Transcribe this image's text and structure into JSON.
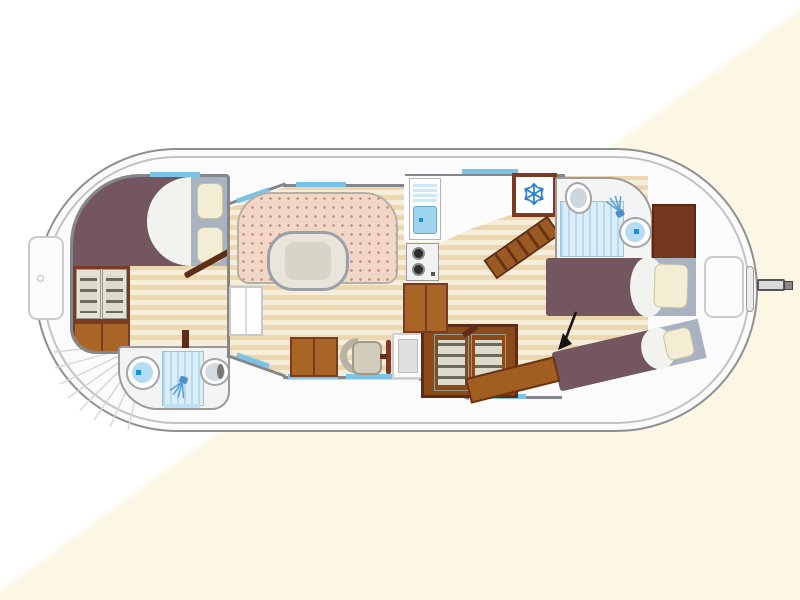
{
  "figure": "pleasure-boat-floor-plan-top-view",
  "palette": {
    "hull_line": "#8f8f8f",
    "deck": "#fbfbfb",
    "wall": "#84878c",
    "window": "#7cc3e8",
    "floor_light": "#f7eed9",
    "floor_dark": "#ecd7ae",
    "wood": "#a96526",
    "wood_dark": "#7b3a22",
    "door_wood": "#5e2d16",
    "bed": "#73565f",
    "pillow": "#f3edd3",
    "pillow_frame": "#a9b2c0",
    "sofa": "#f2d6c6",
    "sofa_dot": "#c69484",
    "table_fill": "#e9e5da",
    "table_border": "#9aa0a8",
    "water_light": "#cfe8f6",
    "water_mid": "#9fd4ee",
    "water_accent": "#1a8fd0",
    "snowflake_blue": "#2a7fd4",
    "shelf": "#6a6a58",
    "arrow": "#151515"
  },
  "rooms": [
    {
      "id": "bow-cabin",
      "contents": [
        "double-bed",
        "wardrobe",
        "cabinet",
        "door"
      ]
    },
    {
      "id": "bow-bathroom",
      "contents": [
        "toilet",
        "shower",
        "washbasin"
      ]
    },
    {
      "id": "saloon",
      "contents": [
        "u-shaped-dinette",
        "oval-table",
        "white-cabinet"
      ]
    },
    {
      "id": "helm-station",
      "contents": [
        "chart-desk",
        "helm-seat",
        "steering-wheel",
        "console",
        "wardrobe"
      ]
    },
    {
      "id": "galley",
      "contents": [
        "sink-with-drainer",
        "two-burner-stove",
        "cabinet",
        "refrigerator",
        "companionway-stairs"
      ]
    },
    {
      "id": "aft-bathroom",
      "contents": [
        "washbasin",
        "shower",
        "toilet"
      ]
    },
    {
      "id": "aft-cabin",
      "contents": [
        "single-bed-straight",
        "single-bed-angled",
        "wardrobe",
        "bench-step"
      ]
    }
  ],
  "deck_features": [
    "bow-hatch",
    "bow-steps-fan",
    "stern-locker",
    "stern-slot",
    "tiller-rudder"
  ],
  "icons": [
    "snowflake-icon",
    "shower-head-icon",
    "direction-arrow-icon"
  ],
  "windows_blue_segments": 8
}
